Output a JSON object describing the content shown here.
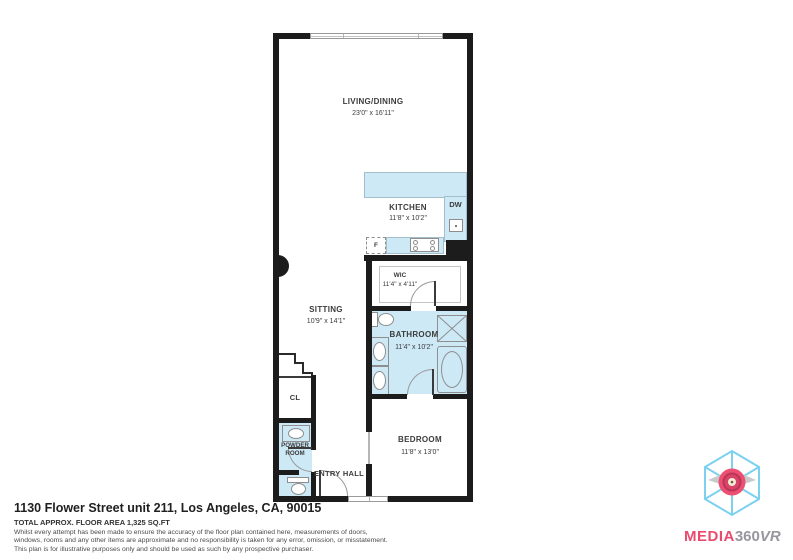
{
  "plan": {
    "rooms": {
      "living": {
        "name": "LIVING/DINING",
        "dims": "23'0\" x 16'11\""
      },
      "kitchen": {
        "name": "KITCHEN",
        "dims": "11'8\" x 10'2\""
      },
      "wic": {
        "name": "WIC",
        "dims": "11'4\" x 4'11\""
      },
      "bathroom": {
        "name": "BATHROOM",
        "dims": "11'4\" x 10'2\""
      },
      "sitting": {
        "name": "SITTING",
        "dims": "10'9\" x 14'1\""
      },
      "bedroom": {
        "name": "BEDROOM",
        "dims": "11'8\" x 13'0\""
      },
      "closet": {
        "name": "CL"
      },
      "powder_room": {
        "name_line1": "POWDER",
        "name_line2": "ROOM"
      },
      "entry_hall": {
        "name": "ENTRY HALL"
      }
    },
    "labels": {
      "dishwasher": "DW",
      "fridge": "F"
    }
  },
  "footer": {
    "address": "1130 Flower Street unit 211, Los Angeles, CA, 90015",
    "area": "TOTAL APPROX. FLOOR AREA 1,325 SQ.FT",
    "disclaimer1": "Whilst every attempt has been made to ensure the accuracy of the floor plan contained here, measurements of doors,",
    "disclaimer2": "windows, rooms and any other items are approximate and no responsibility is taken for any error, omission, or misstatement.",
    "disclaimer3": "This plan is for illustrative purposes only and should be used as such by any prospective purchaser."
  },
  "logo": {
    "brand_media": "MEDIA",
    "brand_360": "360",
    "brand_vr": "VR"
  },
  "colors": {
    "wall": "#1c1c1c",
    "fixture_fill": "#cde9f6",
    "accent_pink": "#e94a6e",
    "logo_gray": "#96969e",
    "cube_blue": "#7cd1f0"
  }
}
